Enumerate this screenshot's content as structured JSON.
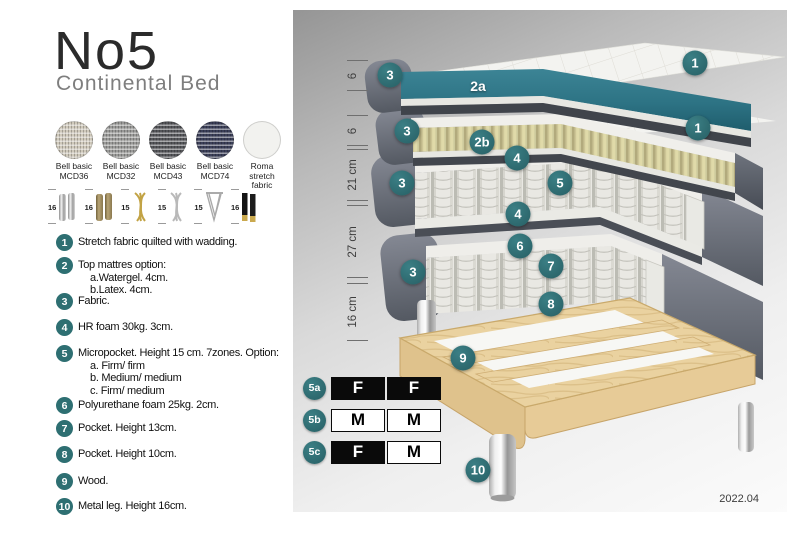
{
  "header": {
    "title": "No5",
    "subtitle": "Continental Bed"
  },
  "swatches": [
    {
      "line1": "Bell basic",
      "line2": "MCD36",
      "color": "#cfc9bb"
    },
    {
      "line1": "Bell basic",
      "line2": "MCD32",
      "color": "#9a9a98"
    },
    {
      "line1": "Bell basic",
      "line2": "MCD43",
      "color": "#55565a"
    },
    {
      "line1": "Bell basic",
      "line2": "MCD74",
      "color": "#3b3f58"
    },
    {
      "line1": "Roma",
      "line2": "stretch fabric",
      "color": "#f2f2ef"
    }
  ],
  "legs": [
    {
      "size": "16",
      "style": "chrome cylinder"
    },
    {
      "size": "16",
      "style": "bronze cylinder"
    },
    {
      "size": "15",
      "style": "gold twisted"
    },
    {
      "size": "15",
      "style": "silver twisted"
    },
    {
      "size": "15",
      "style": "hairpin"
    },
    {
      "size": "16",
      "style": "black with brass tip"
    }
  ],
  "features": [
    {
      "num": "1",
      "text": "Stretch fabric quilted with wadding."
    },
    {
      "num": "2",
      "text": "Top mattres option:",
      "subs": [
        "a.Watergel. 4cm.",
        "b.Latex. 4cm."
      ]
    },
    {
      "num": "3",
      "text": "Fabric."
    },
    {
      "num": "4",
      "text": "HR foam 30kg. 3cm."
    },
    {
      "num": "5",
      "text": "Micropocket. Height 15 cm. 7zones. Option:",
      "subs": [
        "a. Firm/ firm",
        "b. Medium/ medium",
        "c. Firm/ medium"
      ]
    },
    {
      "num": "6",
      "text": "Polyurethane foam 25kg. 2cm."
    },
    {
      "num": "7",
      "text": "Pocket. Height 13cm."
    },
    {
      "num": "8",
      "text": "Pocket. Height 10cm."
    },
    {
      "num": "9",
      "text": "Wood."
    },
    {
      "num": "10",
      "text": "Metal leg. Height 16cm."
    }
  ],
  "diagram": {
    "dimensions": [
      {
        "label": "6"
      },
      {
        "label": "6"
      },
      {
        "label": "21 cm"
      },
      {
        "label": "27 cm"
      },
      {
        "label": "16 cm"
      }
    ],
    "callouts": {
      "n1": "1",
      "n2a": "2a",
      "n2b": "2b",
      "n3": "3",
      "n4": "4",
      "n5": "5",
      "n6": "6",
      "n7": "7",
      "n8": "8",
      "n9": "9",
      "n10": "10"
    },
    "firmness": [
      {
        "label": "5a",
        "cells": [
          "F",
          "F"
        ]
      },
      {
        "label": "5b",
        "cells": [
          "M",
          "M"
        ]
      },
      {
        "label": "5c",
        "cells": [
          "F",
          "M"
        ]
      }
    ],
    "version": "2022.04",
    "colors": {
      "accent_teal": "#2e6f72",
      "watergel": "#2f7787",
      "latex": "#ded8ac",
      "fabric_gray": "#5d626b",
      "wood": "#ead2a0"
    }
  }
}
